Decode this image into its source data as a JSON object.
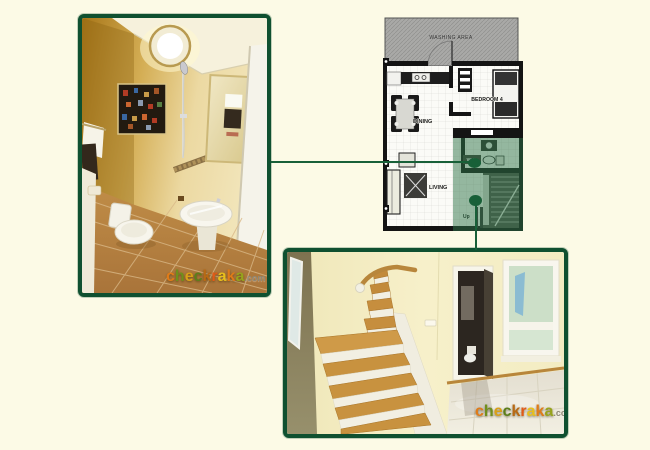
{
  "page": {
    "background": "#fcfae6"
  },
  "colors": {
    "photo_border": "#0f5030",
    "connector_line": "#186038",
    "highlight_overlay": "#2d7347",
    "plan_walls": "#141414",
    "washing_area_fill": "#a9a9a7"
  },
  "floor_plan": {
    "labels": {
      "washing_area": "WASHING AREA",
      "bedroom4": "BEDROOM 4",
      "dining": "DINING",
      "living": "LIVING",
      "wc": "W.C.",
      "up": "Up"
    }
  },
  "watermark": {
    "word": "checkraka",
    "suffix": ".com",
    "letter_colors": [
      "#e07b18",
      "#6f8f1c",
      "#d9a018",
      "#5c7f1a",
      "#b86a14",
      "#e25a16",
      "#e8bf1c",
      "#e07b18",
      "#97a31c"
    ]
  }
}
